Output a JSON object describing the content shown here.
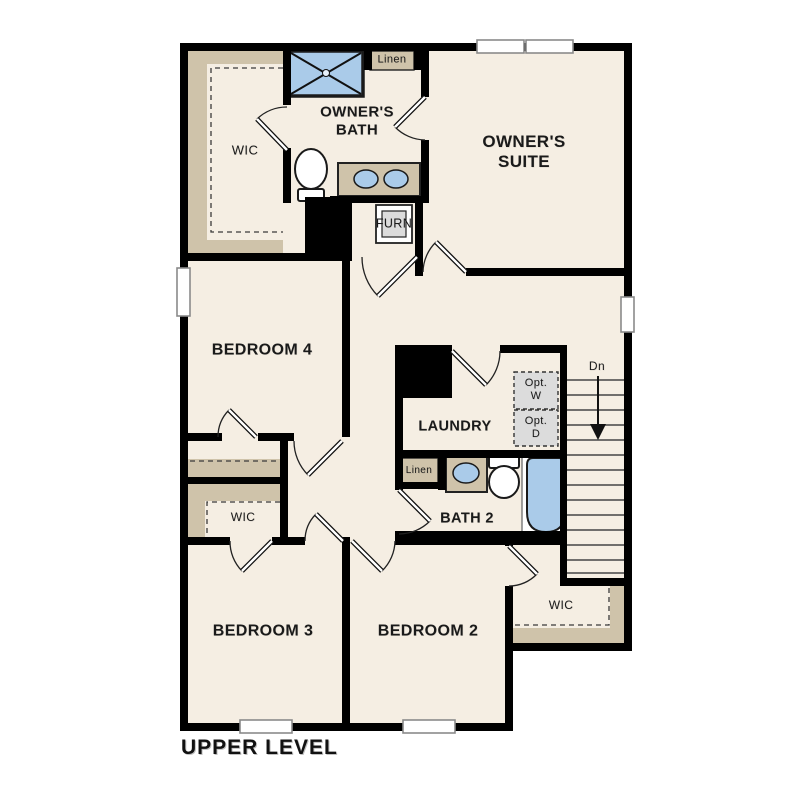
{
  "plan": {
    "level_label": "UPPER LEVEL",
    "rooms": {
      "owners_suite": "OWNER'S\nSUITE",
      "owners_bath": "OWNER'S\nBATH",
      "wic_owners": "WIC",
      "bedroom4": "BEDROOM 4",
      "laundry": "LAUNDRY",
      "bath2": "BATH 2",
      "wic_bed3": "WIC",
      "bedroom3": "BEDROOM 3",
      "bedroom2": "BEDROOM 2",
      "wic_bed2": "WIC"
    },
    "closets": {
      "linen_upper": "Linen",
      "linen_bath2": "Linen",
      "furnace": "FURN"
    },
    "appliances": {
      "opt_washer": "Opt.\nW",
      "opt_dryer": "Opt.\nD"
    },
    "stairs": {
      "down_label": "Dn"
    },
    "fixtures": [
      "shower",
      "toilet",
      "double-vanity-sinks",
      "furnace",
      "optional-washer",
      "optional-dryer",
      "sink",
      "bathtub",
      "stairs-down-arrow",
      "windows",
      "door-swings"
    ],
    "colors": {
      "wall": "#000000",
      "floor": "#f5eee3",
      "shelf": "#cfc3aa",
      "fixture_blue": "#aacbe9",
      "appliance_gray": "#dcdcdc",
      "background": "#ffffff",
      "text": "#1a1a1a"
    }
  }
}
